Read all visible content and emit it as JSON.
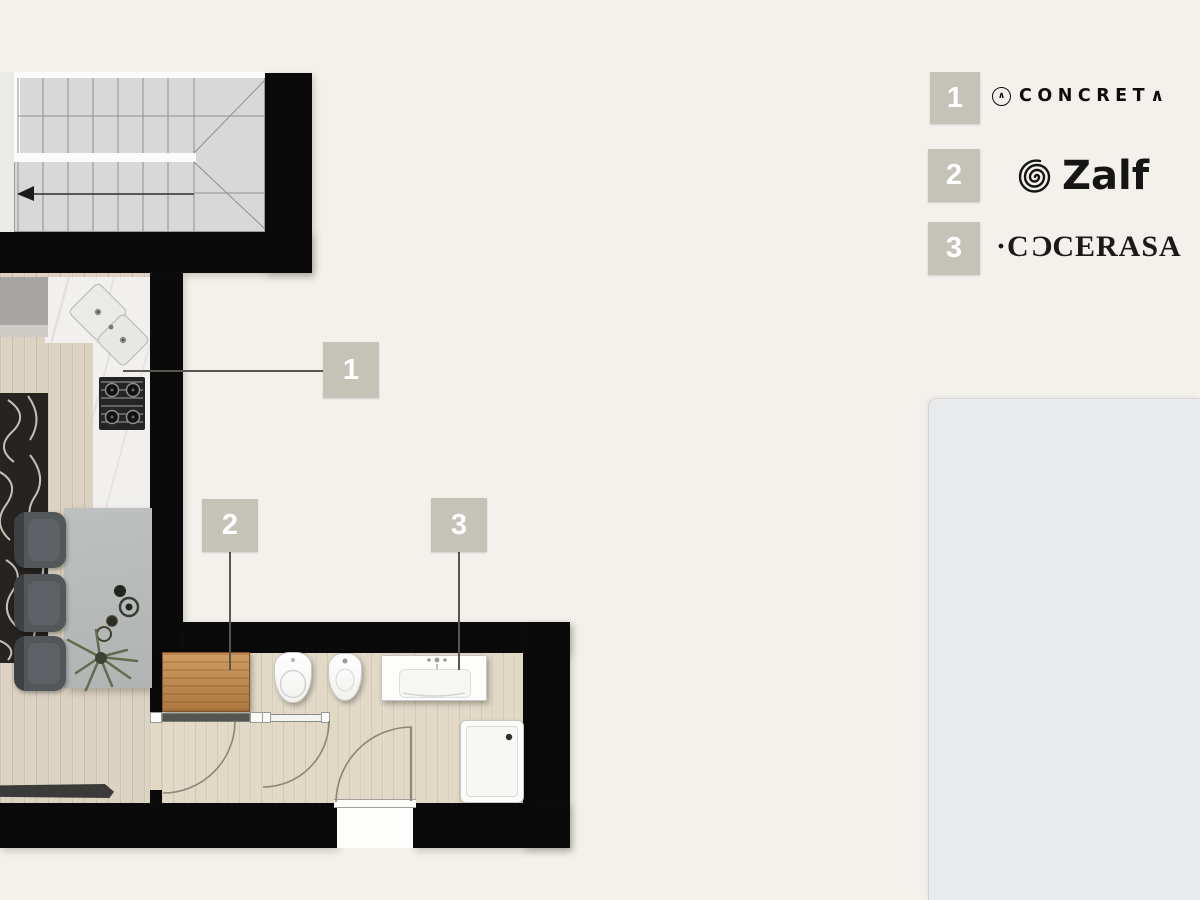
{
  "plan": {
    "markers": [
      {
        "number": "1"
      },
      {
        "number": "2"
      },
      {
        "number": "3"
      }
    ]
  },
  "legend": {
    "items": [
      {
        "number": "1",
        "mark": "∧",
        "text": "CONCRET",
        "suffix": "∧"
      },
      {
        "number": "2",
        "text": "Zalf"
      },
      {
        "number": "3",
        "pre": "·C",
        "mirrored": "C",
        "post": "CERASA"
      }
    ]
  },
  "colors": {
    "background": "#f4f1ed",
    "wall": "#0a0a0a",
    "badge": "#c5c3b8",
    "panel": "#e9eaeb"
  }
}
